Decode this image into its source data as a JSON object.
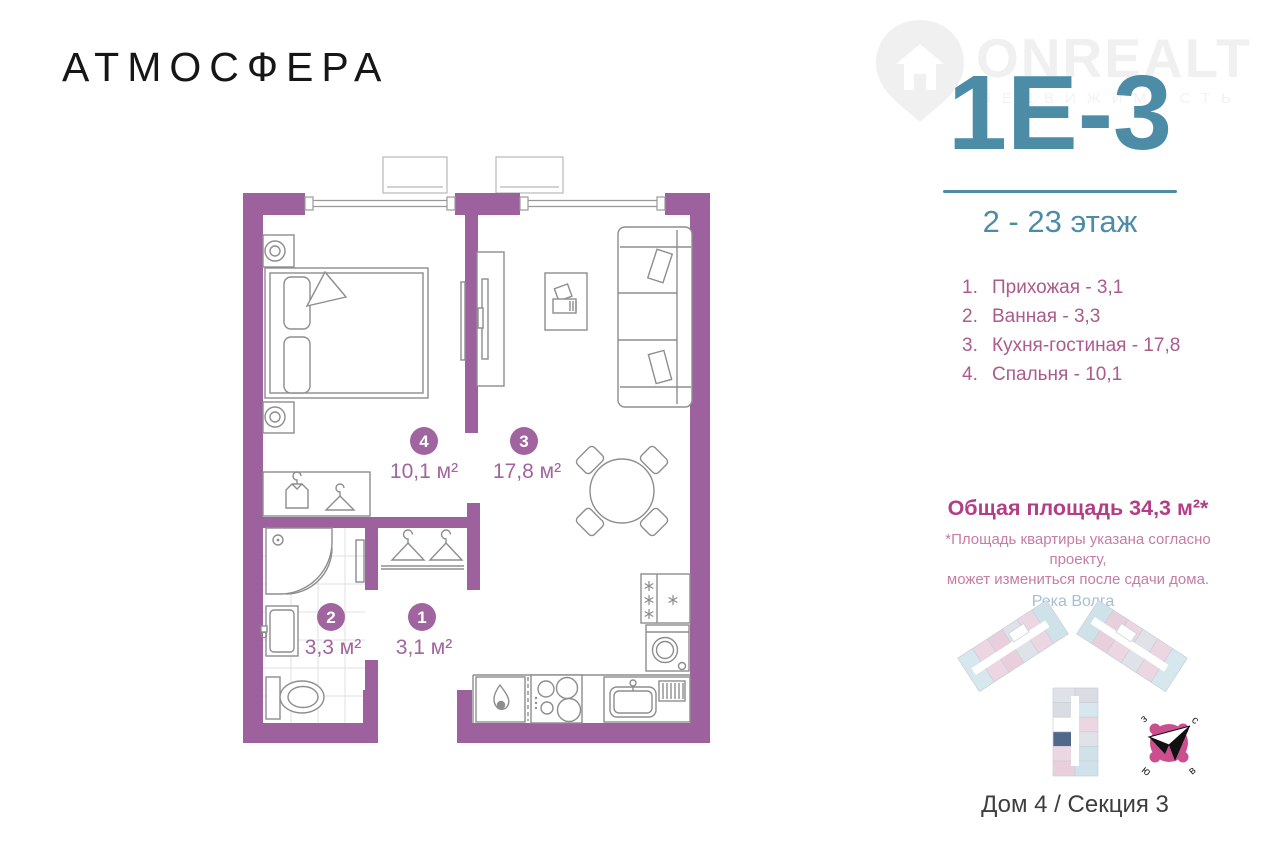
{
  "brand": {
    "logo": "АТМОСФЕРА"
  },
  "watermark": {
    "title": "ONREALT",
    "subtitle": "НЕДВИЖИМОСТЬ",
    "icon": "house-pin-icon"
  },
  "unit": {
    "code": "1Е-3",
    "floors": "2 - 23 этаж"
  },
  "legend": {
    "items": [
      {
        "num": "1.",
        "text": "Прихожая - 3,1"
      },
      {
        "num": "2.",
        "text": "Ванная - 3,3"
      },
      {
        "num": "3.",
        "text": "Кухня-гостиная - 17,8"
      },
      {
        "num": "4.",
        "text": "Спальня - 10,1"
      }
    ]
  },
  "total": {
    "title": "Общая площадь 34,3 м²*",
    "note_line1": "*Площадь квартиры указана согласно проекту,",
    "note_line2": "может измениться после сдачи дома."
  },
  "plan": {
    "room1": {
      "num": "1",
      "area": "3,1 м²"
    },
    "room2": {
      "num": "2",
      "area": "3,3 м²"
    },
    "room3": {
      "num": "3",
      "area": "17,8 м²"
    },
    "room4": {
      "num": "4",
      "area": "10,1 м²"
    },
    "icons": [
      "bed",
      "nightstand-lamp",
      "wardrobe-shirt",
      "hanger",
      "shower",
      "sink",
      "toilet",
      "tv-unit",
      "desk",
      "sofa",
      "dining-table",
      "gas-flame",
      "hob",
      "kitchen-sink",
      "fridge-snowflake",
      "washing-machine"
    ]
  },
  "location": {
    "river": "Река Волга",
    "building": "Дом 4 / Секция 3",
    "compass": {
      "north": "с",
      "east": "в",
      "south": "ю",
      "west": "з"
    }
  },
  "colors": {
    "accent_teal": "#4d8ca7",
    "wall_purple": "#9d619d",
    "badge_purple": "#a0659f",
    "legend_pink": "#ab5b8d",
    "total_pink": "#b23f85",
    "note_pink": "#c57ca7",
    "river_blue": "#a3bfd4",
    "compass_pink": "#cb4e8f",
    "highlight_navy": "#51688b",
    "text_dark": "#3e3e3e"
  }
}
